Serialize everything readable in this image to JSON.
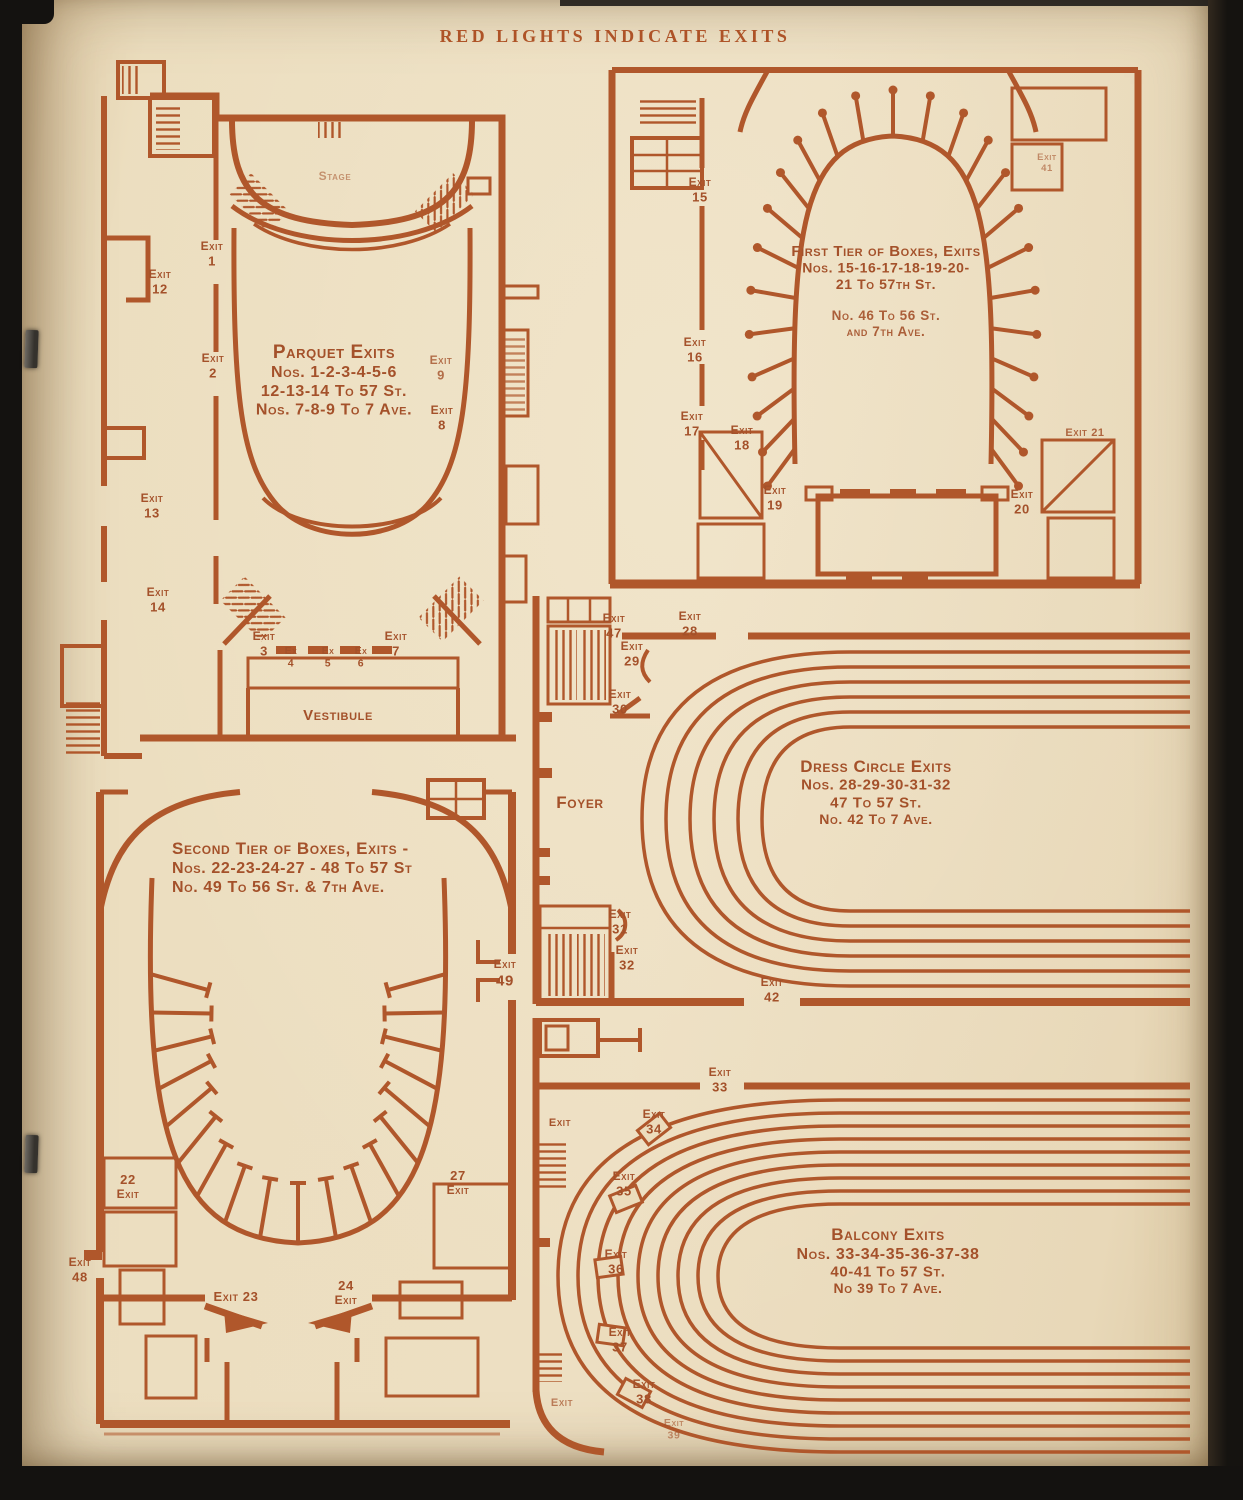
{
  "page": {
    "title": "RED LIGHTS INDICATE EXITS"
  },
  "ink_color": "#b0572b",
  "paper_color": "#ecdebf",
  "diagrams": {
    "parquet": {
      "title": "Parquet Exits",
      "labels": {
        "stage": {
          "x": 335,
          "y": 180,
          "size": 12,
          "o": 0.55,
          "lines": [
            "Stage"
          ]
        },
        "exit-1": {
          "x": 212,
          "y": 250,
          "lines": [
            "Exit",
            "1"
          ]
        },
        "exit-12": {
          "x": 160,
          "y": 278,
          "lines": [
            "Exit",
            "12"
          ]
        },
        "exit-2": {
          "x": 213,
          "y": 362,
          "lines": [
            "Exit",
            "2"
          ]
        },
        "exit-9": {
          "x": 441,
          "y": 364,
          "o": 0.8,
          "lines": [
            "Exit",
            "9"
          ]
        },
        "exit-8": {
          "x": 442,
          "y": 414,
          "lines": [
            "Exit",
            "8"
          ]
        },
        "exit-13": {
          "x": 152,
          "y": 502,
          "lines": [
            "Exit",
            "13"
          ]
        },
        "exit-14": {
          "x": 158,
          "y": 596,
          "lines": [
            "Exit",
            "14"
          ]
        },
        "exit-3": {
          "x": 264,
          "y": 640,
          "lines": [
            "Exit",
            "3"
          ]
        },
        "ex-4": {
          "x": 291,
          "y": 654,
          "size": 10.5,
          "lines": [
            "Ex",
            "4"
          ]
        },
        "ex-5": {
          "x": 328,
          "y": 654,
          "size": 10.5,
          "lines": [
            "Ex",
            "5"
          ]
        },
        "ex-6": {
          "x": 361,
          "y": 654,
          "size": 10.5,
          "lines": [
            "Ex",
            "6"
          ]
        },
        "exit-7": {
          "x": 396,
          "y": 640,
          "lines": [
            "Exit",
            "7"
          ]
        },
        "vestibule": {
          "x": 338,
          "y": 720,
          "size": 15,
          "ls": 3,
          "lines": [
            "Vestibule"
          ]
        },
        "caption": {
          "x": 334,
          "y": 358,
          "sizes": [
            19,
            16,
            16,
            16
          ],
          "lines": [
            "Parquet Exits",
            "Nos. 1-2-3-4-5-6",
            "12-13-14 To 57 St.",
            "Nos. 7-8-9 To 7 Ave."
          ]
        }
      }
    },
    "first_tier": {
      "title": "First Tier of Boxes, Exits",
      "labels": {
        "exit-15": {
          "x": 700,
          "y": 186,
          "lines": [
            "Exit",
            "15"
          ]
        },
        "exit-41": {
          "x": 1047,
          "y": 160,
          "size": 9.5,
          "o": 0.6,
          "lines": [
            "Exit",
            "41"
          ]
        },
        "exit-16": {
          "x": 695,
          "y": 346,
          "lines": [
            "Exit",
            "16"
          ]
        },
        "exit-17": {
          "x": 692,
          "y": 420,
          "lines": [
            "Exit",
            "17"
          ]
        },
        "exit-18": {
          "x": 742,
          "y": 434,
          "lines": [
            "Exit",
            "18"
          ]
        },
        "exit-19": {
          "x": 775,
          "y": 494,
          "lines": [
            "Exit",
            "19"
          ]
        },
        "exit-20": {
          "x": 1022,
          "y": 498,
          "lines": [
            "Exit",
            "20"
          ]
        },
        "exit-21": {
          "x": 1085,
          "y": 436,
          "size": 11,
          "o": 0.85,
          "lines": [
            "Exit 21"
          ]
        },
        "caption": {
          "x": 886,
          "y": 256,
          "sizes": [
            15,
            14,
            14
          ],
          "lines": [
            "First Tier of Boxes, Exits",
            "Nos. 15-16-17-18-19-20-",
            "21 To 57th St."
          ]
        },
        "caption2": {
          "x": 886,
          "y": 320,
          "sizes": [
            13.5,
            13.5
          ],
          "o": 0.9,
          "lines": [
            "No. 46 To 56 St.",
            "and 7th Ave."
          ]
        }
      }
    },
    "dress_circle": {
      "title": "Dress Circle Exits",
      "labels": {
        "exit-47": {
          "x": 614,
          "y": 622,
          "lines": [
            "Exit",
            "47"
          ]
        },
        "exit-28": {
          "x": 690,
          "y": 620,
          "lines": [
            "Exit",
            "28"
          ]
        },
        "exit-29": {
          "x": 632,
          "y": 650,
          "lines": [
            "Exit",
            "29"
          ]
        },
        "exit-30": {
          "x": 620,
          "y": 698,
          "lines": [
            "Exit",
            "30"
          ]
        },
        "foyer": {
          "x": 580,
          "y": 808,
          "size": 17,
          "ls": 4,
          "lines": [
            "Foyer"
          ]
        },
        "exit-31": {
          "x": 620,
          "y": 918,
          "lines": [
            "Exit",
            "31"
          ]
        },
        "exit-32": {
          "x": 627,
          "y": 954,
          "lines": [
            "Exit",
            "32"
          ]
        },
        "exit-42": {
          "x": 772,
          "y": 986,
          "lines": [
            "Exit",
            "42"
          ]
        },
        "caption": {
          "x": 876,
          "y": 772,
          "sizes": [
            17,
            15,
            15,
            14
          ],
          "lines": [
            "Dress Circle Exits",
            "Nos. 28-29-30-31-32",
            "47 To 57 St.",
            "No. 42 To 7 Ave."
          ]
        }
      }
    },
    "second_tier": {
      "title": "Second Tier of Boxes, Exits",
      "labels": {
        "caption": {
          "x": 172,
          "y": 854,
          "a": "start",
          "sizes": [
            17,
            16,
            16
          ],
          "lines": [
            "Second Tier of Boxes, Exits -",
            "Nos. 22-23-24-27 - 48 To 57 St",
            "No. 49 To 56 St. & 7th Ave."
          ]
        },
        "exit-49": {
          "x": 505,
          "y": 968,
          "sizes": [
            12,
            15
          ],
          "lines": [
            "Exit",
            "49"
          ]
        },
        "exit-22": {
          "x": 128,
          "y": 1184,
          "sizes": [
            13,
            12
          ],
          "lines": [
            "22",
            "Exit"
          ]
        },
        "exit-27": {
          "x": 458,
          "y": 1180,
          "sizes": [
            13,
            12
          ],
          "lines": [
            "27",
            "Exit"
          ]
        },
        "exit-48": {
          "x": 80,
          "y": 1266,
          "lines": [
            "Exit",
            "48"
          ]
        },
        "exit-23": {
          "x": 236,
          "y": 1301,
          "size": 13,
          "lines": [
            "Exit 23"
          ]
        },
        "exit-24": {
          "x": 346,
          "y": 1290,
          "sizes": [
            13,
            12
          ],
          "lines": [
            "24",
            "Exit"
          ]
        }
      }
    },
    "balcony": {
      "title": "Balcony Exits",
      "labels": {
        "exit-33": {
          "x": 720,
          "y": 1076,
          "lines": [
            "Exit",
            "33"
          ]
        },
        "exit-wall-upper": {
          "x": 560,
          "y": 1126,
          "size": 11,
          "lines": [
            "Exit"
          ]
        },
        "exit-34": {
          "x": 654,
          "y": 1118,
          "lines": [
            "Exit",
            "34"
          ]
        },
        "exit-35": {
          "x": 624,
          "y": 1180,
          "lines": [
            "Exit",
            "35"
          ]
        },
        "exit-36": {
          "x": 616,
          "y": 1258,
          "lines": [
            "Exit",
            "36"
          ]
        },
        "exit-37": {
          "x": 620,
          "y": 1336,
          "lines": [
            "Exit",
            "37"
          ]
        },
        "exit-38": {
          "x": 644,
          "y": 1388,
          "lines": [
            "Exit",
            "38"
          ]
        },
        "exit-wall-lower": {
          "x": 562,
          "y": 1406,
          "size": 11,
          "o": 0.7,
          "lines": [
            "Exit"
          ]
        },
        "exit-39": {
          "x": 674,
          "y": 1426,
          "size": 10.5,
          "o": 0.6,
          "lines": [
            "Exit",
            "39"
          ]
        },
        "caption": {
          "x": 888,
          "y": 1240,
          "sizes": [
            17,
            16,
            15,
            14
          ],
          "lines": [
            "Balcony Exits",
            "Nos. 33-34-35-36-37-38",
            "40-41 To 57 St.",
            "No 39 To 7 Ave."
          ]
        }
      }
    }
  }
}
